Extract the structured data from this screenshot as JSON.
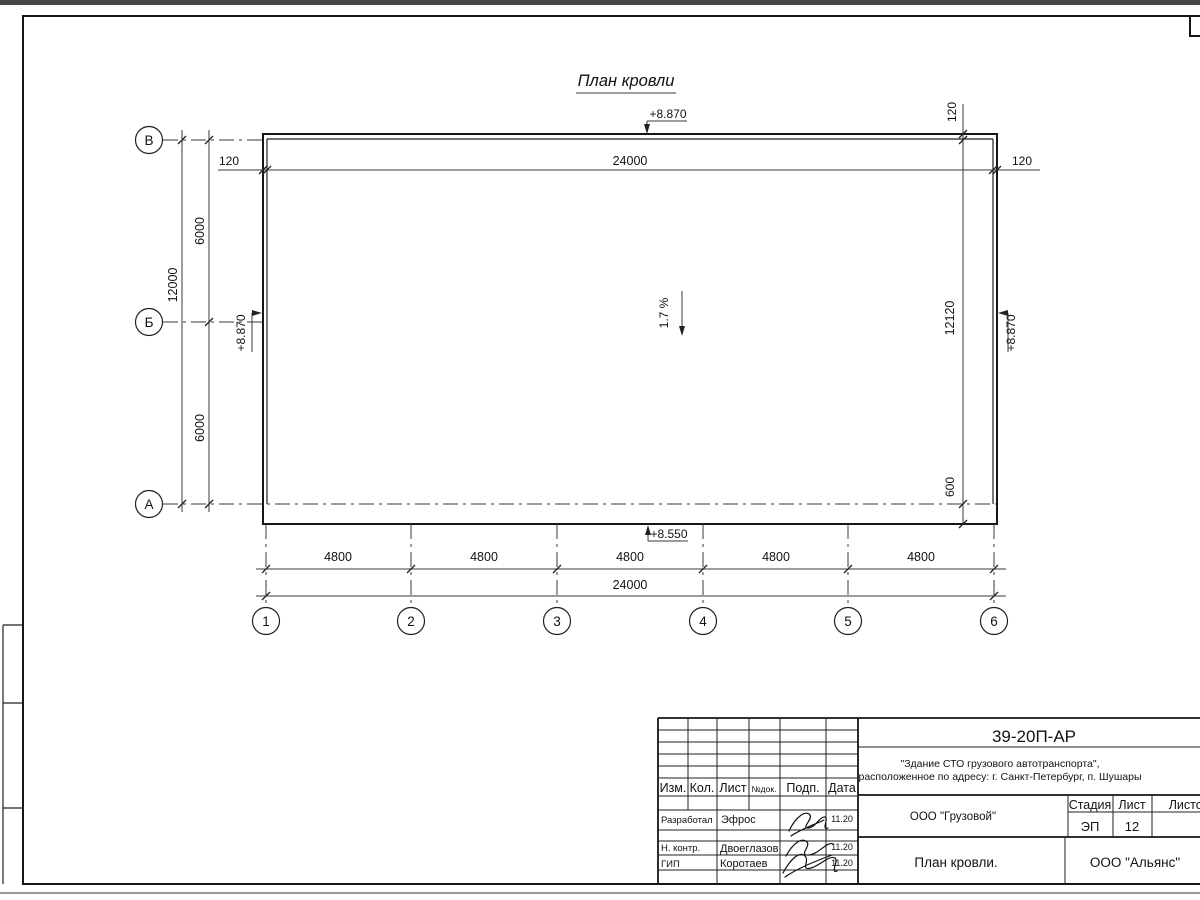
{
  "drawing": {
    "title": "План кровли",
    "slope_label": "1.7 %",
    "elevations": {
      "top": "+8.870",
      "left": "+8.870",
      "right": "+8.870",
      "bottom": "+8.550"
    },
    "dims": {
      "top": {
        "left_offset": "120",
        "overall": "24000",
        "right_offset": "120"
      },
      "left": {
        "overall": "12000",
        "segments": [
          "6000",
          "6000"
        ]
      },
      "right": {
        "top_offset": "120",
        "overall": "12120",
        "bottom_offset": "600"
      },
      "bottom": {
        "segments": [
          "4800",
          "4800",
          "4800",
          "4800",
          "4800"
        ],
        "overall": "24000"
      }
    },
    "axes": {
      "rows": [
        "В",
        "Б",
        "А"
      ],
      "cols": [
        "1",
        "2",
        "3",
        "4",
        "5",
        "6"
      ]
    }
  },
  "titleblock": {
    "doc_number": "39-20П-АР",
    "object_line1": "\"Здание СТО грузового автотранспорта\",",
    "object_line2": "расположенное по адресу: г. Санкт-Петербург, п. Шушары",
    "columns": {
      "izm": "Изм.",
      "kol": "Кол.",
      "list": "Лист",
      "ndok": "№док.",
      "podp": "Подп.",
      "data": "Дата"
    },
    "rows": [
      {
        "role": "Разработал",
        "name": "Эфрос",
        "date": "11.20"
      },
      {
        "role": "Н. контр.",
        "name": "Двоеглазов",
        "date": "11.20"
      },
      {
        "role": "ГИП",
        "name": "Коротаев",
        "date": "11.20"
      }
    ],
    "company": "ООО \"Грузовой\"",
    "stage_label": "Стадия",
    "stage_value": "ЭП",
    "sheet_label": "Лист",
    "sheet_value": "12",
    "sheets_label": "Листов",
    "sheet_title": "План кровли.",
    "org": "ООО \"Альянс\""
  }
}
